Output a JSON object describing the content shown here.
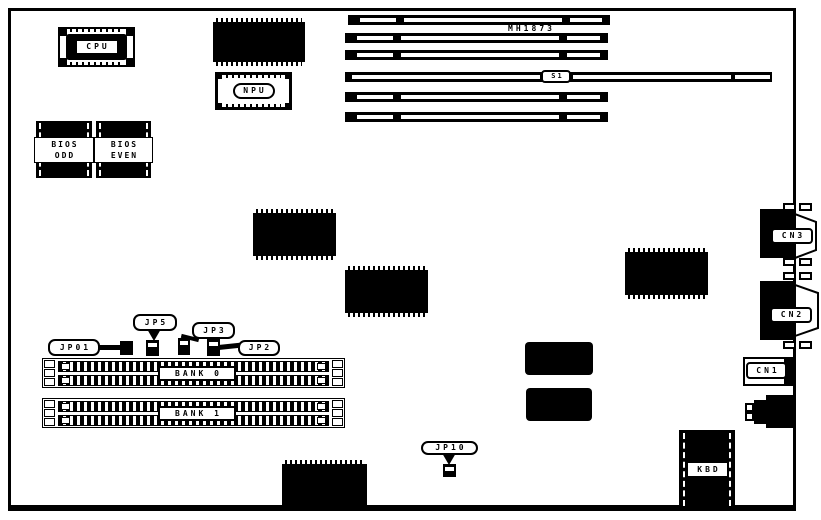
{
  "board": {
    "cpu": {
      "label": "CPU"
    },
    "npu": {
      "label": "NPU"
    },
    "bios_odd": {
      "line1": "BIOS",
      "line2": "ODD"
    },
    "bios_even": {
      "line1": "BIOS",
      "line2": "EVEN"
    },
    "slots": {
      "model_label": "MH1873",
      "switch_label": "S1"
    },
    "jumpers": {
      "jp01": "JP01",
      "jp5": "JP5",
      "jp3": "JP3",
      "jp2": "JP2",
      "jp10": "JP10"
    },
    "memory": {
      "bank0": "BANK 0",
      "bank1": "BANK 1"
    },
    "connectors": {
      "cn1": "CN1",
      "cn2": "CN2",
      "cn3": "CN3",
      "kbd": "KBD"
    },
    "colors": {
      "ink": "#000000",
      "background": "#ffffff"
    }
  }
}
